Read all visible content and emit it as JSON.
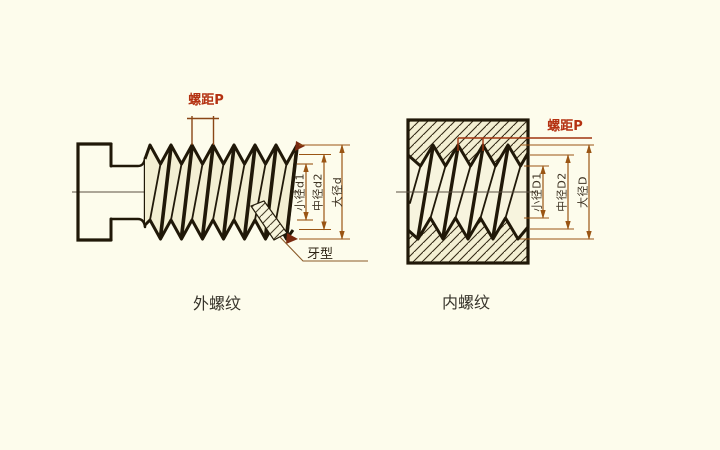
{
  "figure_title": "screw thread terminology diagram",
  "left_figure": {
    "caption": "外螺纹",
    "pitch_label": "螺距P",
    "dim_labels": {
      "minor": "小径d1",
      "pitch_diameter": "中径d2",
      "major": "大径d"
    },
    "profile_label": "牙型"
  },
  "right_figure": {
    "caption": "内螺纹",
    "pitch_label": "螺距P",
    "dim_labels": {
      "minor": "小径D1",
      "pitch_diameter": "中径D2",
      "major": "大径D"
    }
  },
  "colors": {
    "background": "#fdfcec",
    "paper_fill": "#f3efd3",
    "line": "#201808",
    "dimension_line": "#9a5514",
    "pitch_marker": "#8a4616",
    "pitch_label_text": "#b43111",
    "dim_label_text": "#3f3424",
    "caption_text": "#37342b"
  }
}
